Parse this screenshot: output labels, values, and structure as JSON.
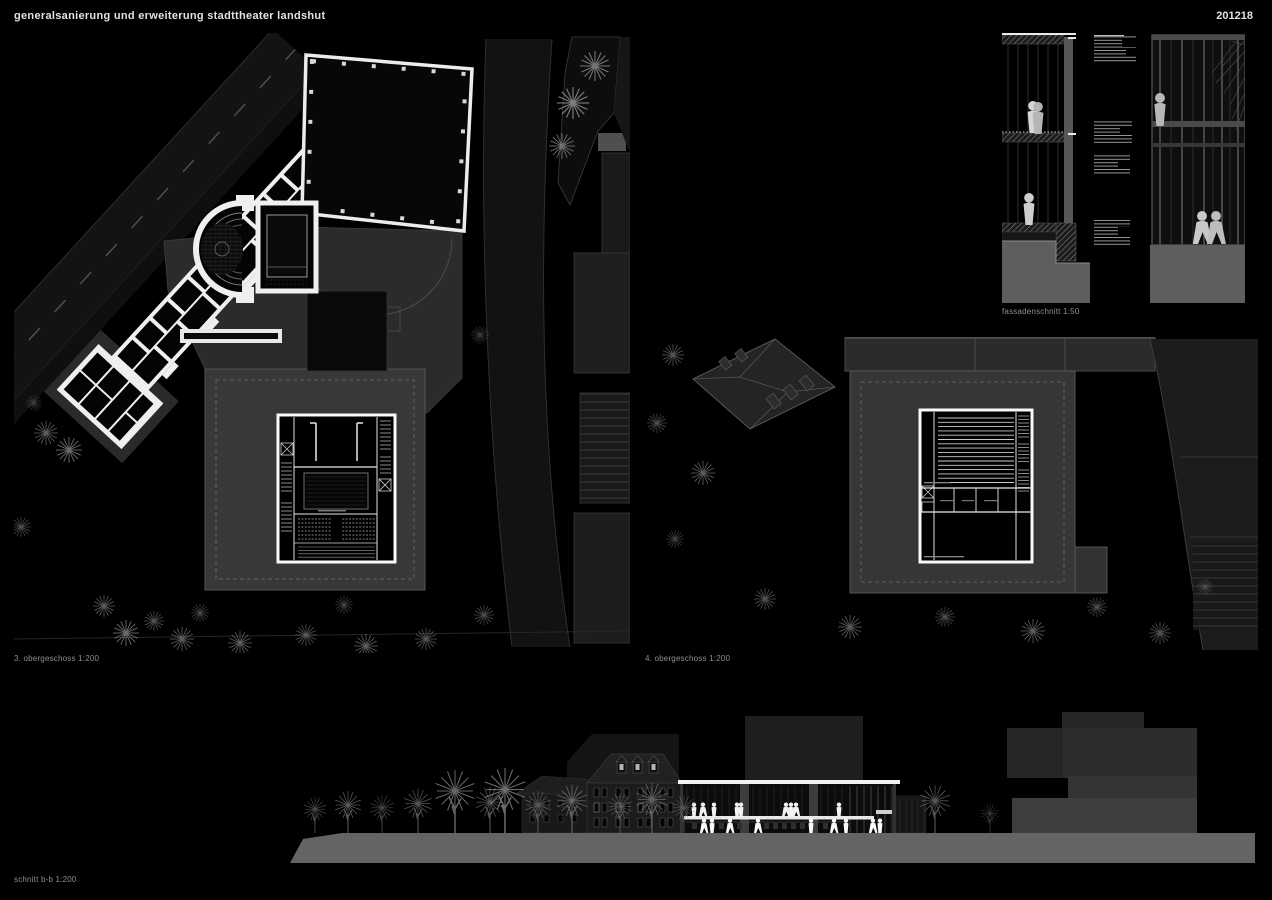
{
  "header": {
    "title": "generalsanierung und erweiterung stadttheater landshut",
    "code": "201218"
  },
  "panels": {
    "plan3": {
      "caption": "3. obergeschoss 1:200"
    },
    "plan4": {
      "caption": "4. obergeschoss 1:200"
    },
    "facade": {
      "caption": "fassadenschnitt 1:50"
    },
    "section": {
      "caption": "schnitt b-b 1:200"
    }
  },
  "colors": {
    "background": "#000000",
    "drawing_white": "#f2f2f2",
    "site_gray": "#383838",
    "ground_gray": "#646464",
    "title_text": "#e2e2e2",
    "caption_text": "#8f8f8f"
  }
}
